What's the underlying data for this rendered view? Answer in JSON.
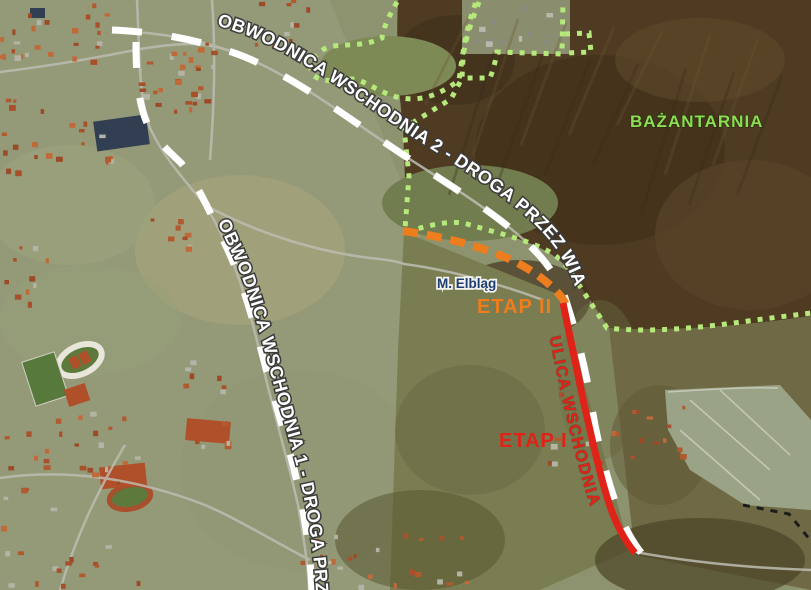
{
  "map": {
    "labels": {
      "obwodnica2": "OBWODNICA WSCHODNIA 2 - DROGA PRZEZ WIATY",
      "obwodnica1": "OBWODNICA WSCHODNIA 1 - DROGA PRZEZ ROD",
      "etap2": "ETAP II",
      "etap1": "ETAP I",
      "ulica_wschodnia": "ULICA WSCHODNIA",
      "bazantarnia": "BAŻANTARNIA",
      "city": "M. Elbląg"
    },
    "colors": {
      "stage1_red": "#df2318",
      "stage2_orange": "#ee7d1d",
      "bypass_white": "#ffffff",
      "boundary_green": "#b6e97b",
      "forest_label_green": "#8ade52",
      "city_label_navy": "#203d71",
      "black_boundary": "#1c1c1c"
    },
    "route_styles": {
      "obwodnica_routes": "white dashed line",
      "etap2_route": "orange dashed line",
      "etap1_route": "red solid line",
      "nature_boundary": "green dotted line"
    }
  }
}
